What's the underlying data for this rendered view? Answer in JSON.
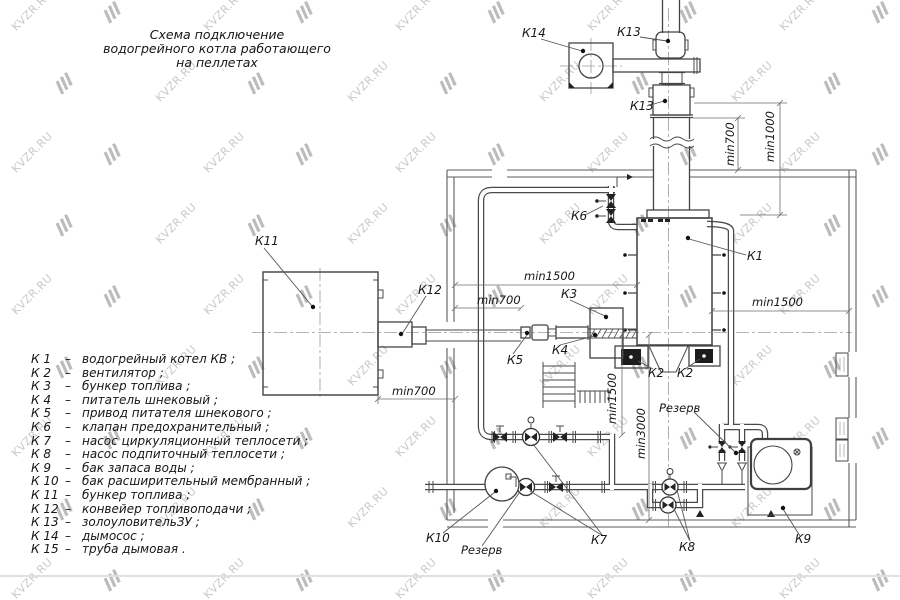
{
  "title": {
    "line1": "Схема подключение",
    "line2": "водогрейного котла работающего",
    "line3": "на пеллетах"
  },
  "legend": {
    "items": [
      {
        "key": "К 1",
        "dash": "–",
        "desc": "водогрейный котел КВ ;"
      },
      {
        "key": "К 2",
        "dash": "–",
        "desc": "вентилятор ;"
      },
      {
        "key": "К 3",
        "dash": "–",
        "desc": "бункер топлива ;"
      },
      {
        "key": "К 4",
        "dash": "–",
        "desc": "питатель шнековый ;"
      },
      {
        "key": "К 5",
        "dash": "–",
        "desc": "привод питателя шнекового ;"
      },
      {
        "key": "К 6",
        "dash": "–",
        "desc": "клапан предохранительный ;"
      },
      {
        "key": "К 7",
        "dash": "–",
        "desc": "насос циркуляционный теплосети ;"
      },
      {
        "key": "К 8",
        "dash": "–",
        "desc": "насос подпиточный теплосети ;"
      },
      {
        "key": "К 9",
        "dash": "–",
        "desc": "бак запаса воды ;"
      },
      {
        "key": "К 10",
        "dash": "–",
        "desc": "бак расширительный мембранный ;"
      },
      {
        "key": "К 11",
        "dash": "–",
        "desc": "бункер топлива ;"
      },
      {
        "key": "К 12",
        "dash": "–",
        "desc": "конвейер топливоподачи ;"
      },
      {
        "key": "К 13",
        "dash": "–",
        "desc": "золоуловительЗУ ;"
      },
      {
        "key": "К 14",
        "dash": "–",
        "desc": "дымосос ;"
      },
      {
        "key": "К 15",
        "dash": "–",
        "desc": "труба дымовая ."
      }
    ]
  },
  "watermark": {
    "text": "KVZR.RU",
    "text_color": "#c9c9c9",
    "logo_color": "#bcbcbc"
  },
  "diagram": {
    "labels": {
      "k1": "К1",
      "k2_left": "К2",
      "k2_right": "К2",
      "k3": "К3",
      "k4": "К4",
      "k5": "К5",
      "k6": "К6",
      "k7": "К7",
      "k8": "К8",
      "k9": "К9",
      "k10": "К10",
      "k11": "К11",
      "k12": "К12",
      "k13_top": "К13",
      "k13_body": "К13",
      "k14": "К14",
      "reserve_top": "Резерв",
      "reserve_bottom": "Резерв",
      "dim_top_min1500": "min1500",
      "dim_topleft_min700": "min700",
      "dim_bottomleft_min700": "min700",
      "dim_right_min1500": "min1500",
      "dim_vert_min700": "min700",
      "dim_vert_min1000": "min1000",
      "dim_vert_min1500": "min1500",
      "dim_vert_min3000": "min3000"
    }
  }
}
